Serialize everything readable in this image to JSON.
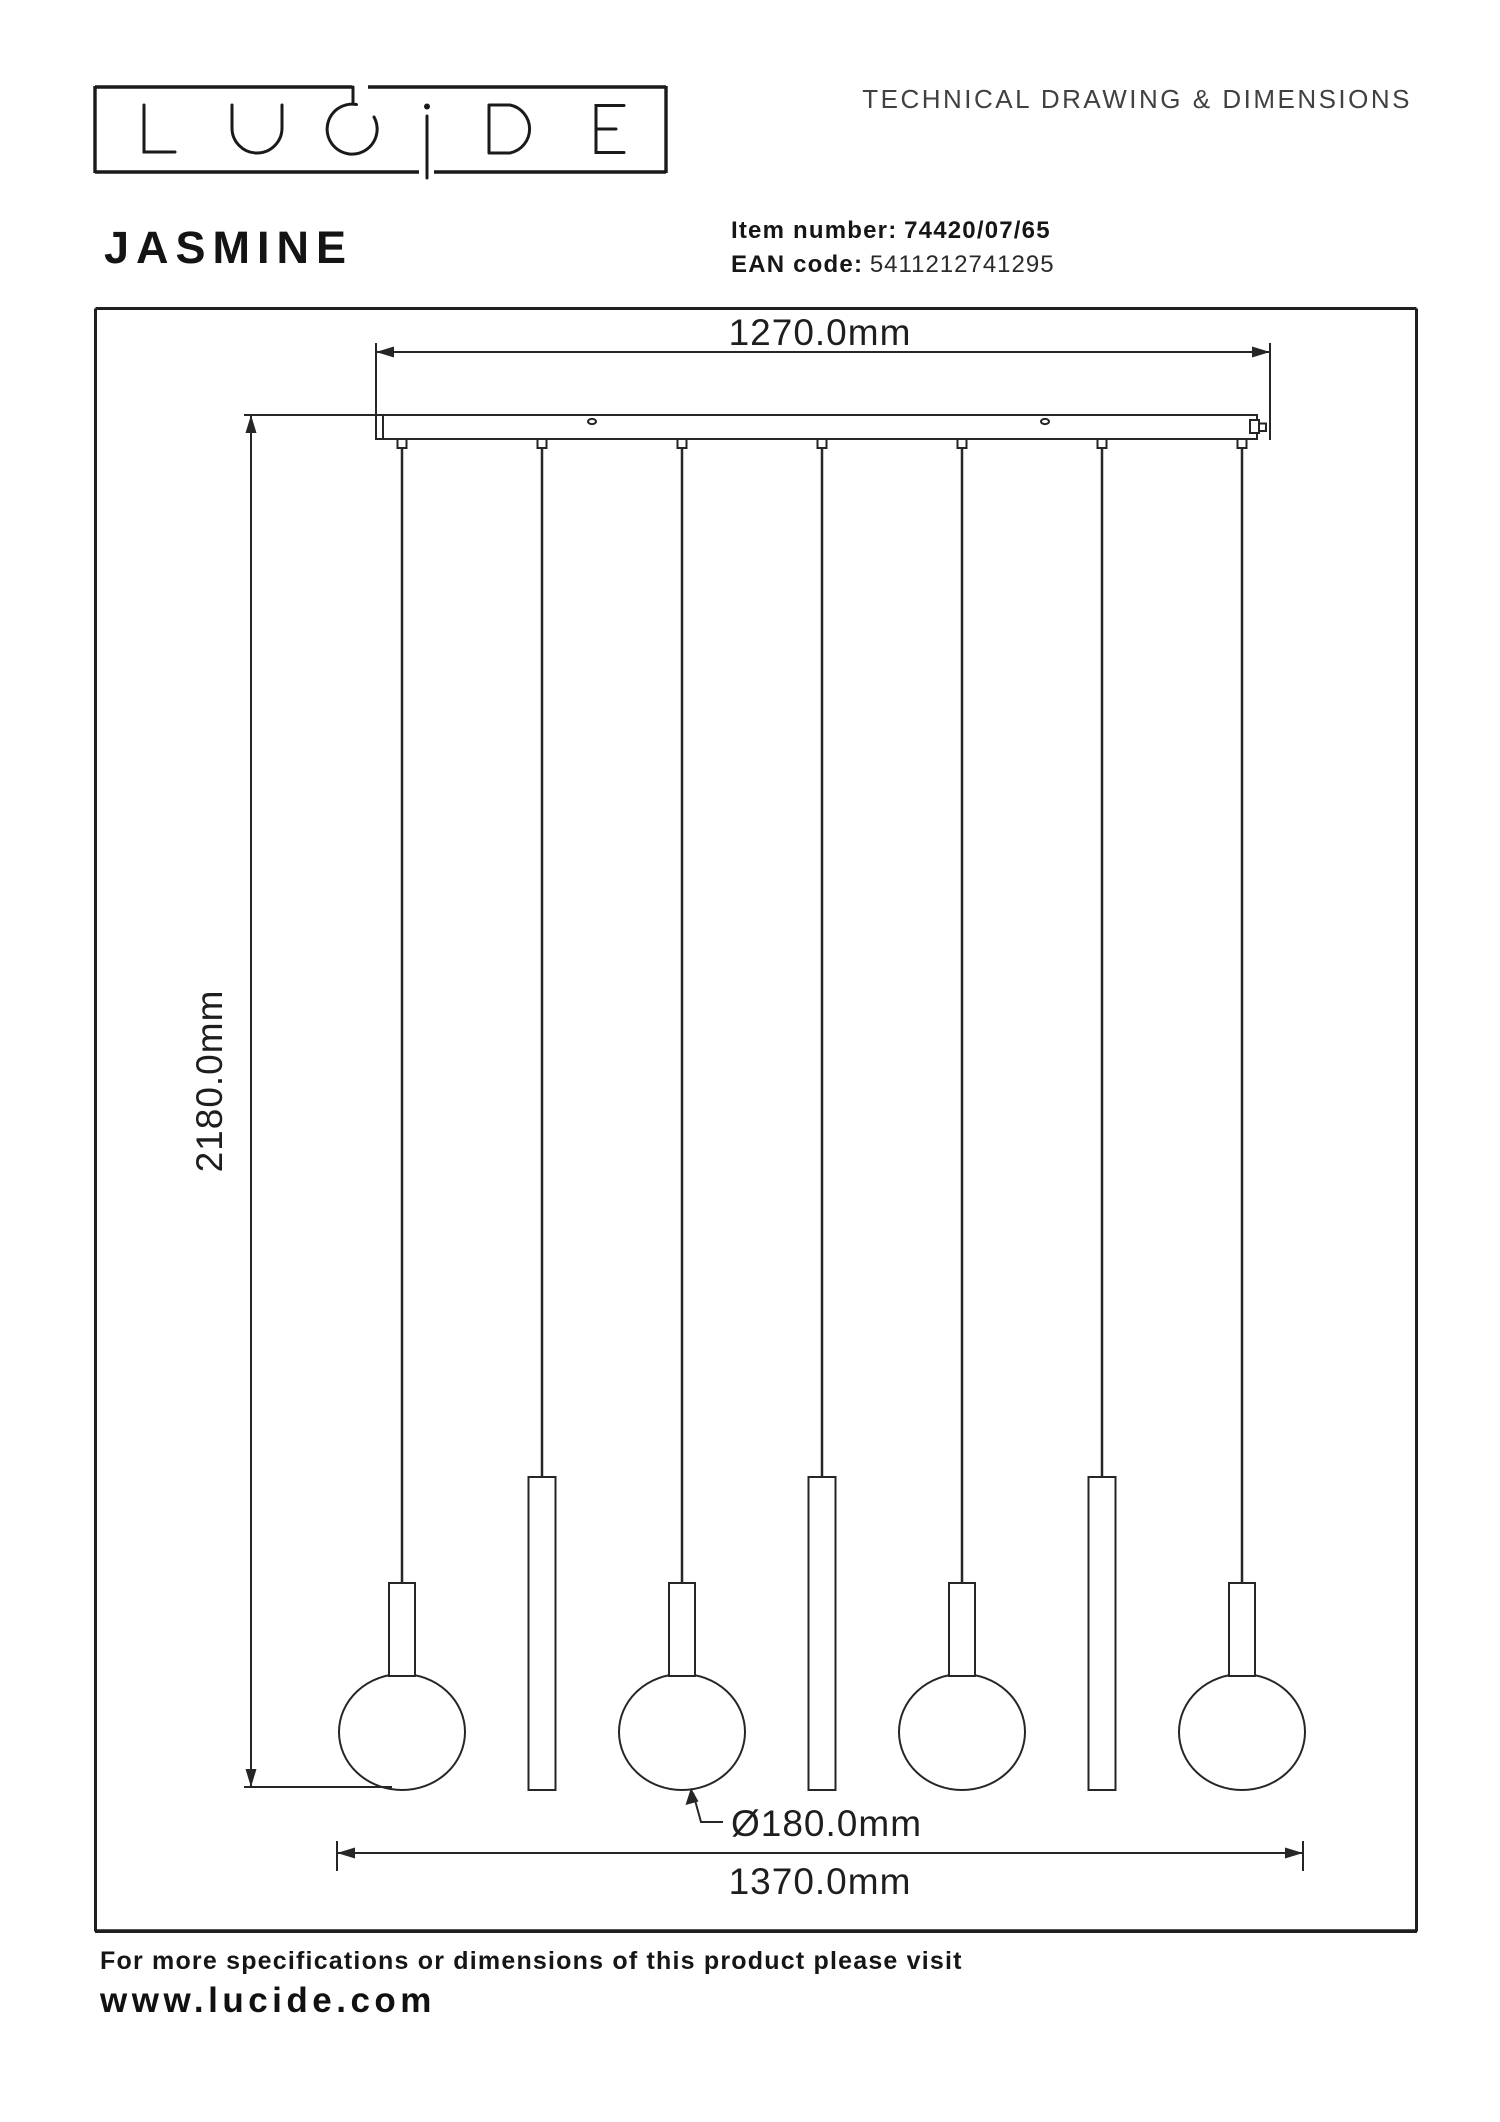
{
  "header": {
    "logo_text": "LUCIDE",
    "title": "TECHNICAL DRAWING & DIMENSIONS"
  },
  "product": {
    "name": "JASMINE",
    "item_label": "Item number:",
    "item_value": "74420/07/65",
    "ean_label": "EAN code:",
    "ean_value": "5411212741295"
  },
  "drawing": {
    "dim_top_width": "1270.0mm",
    "dim_height": "2180.0mm",
    "dim_diameter": "Ø180.0mm",
    "dim_bottom_width": "1370.0mm",
    "pendants": [
      "ball",
      "tube",
      "ball",
      "tube",
      "ball",
      "tube",
      "ball"
    ]
  },
  "footer": {
    "note": "For more specifications or dimensions of this product please visit",
    "website": "www.lucide.com"
  },
  "colors": {
    "ink": "#1c1c1c",
    "line": "#262626",
    "muted": "#414141"
  }
}
